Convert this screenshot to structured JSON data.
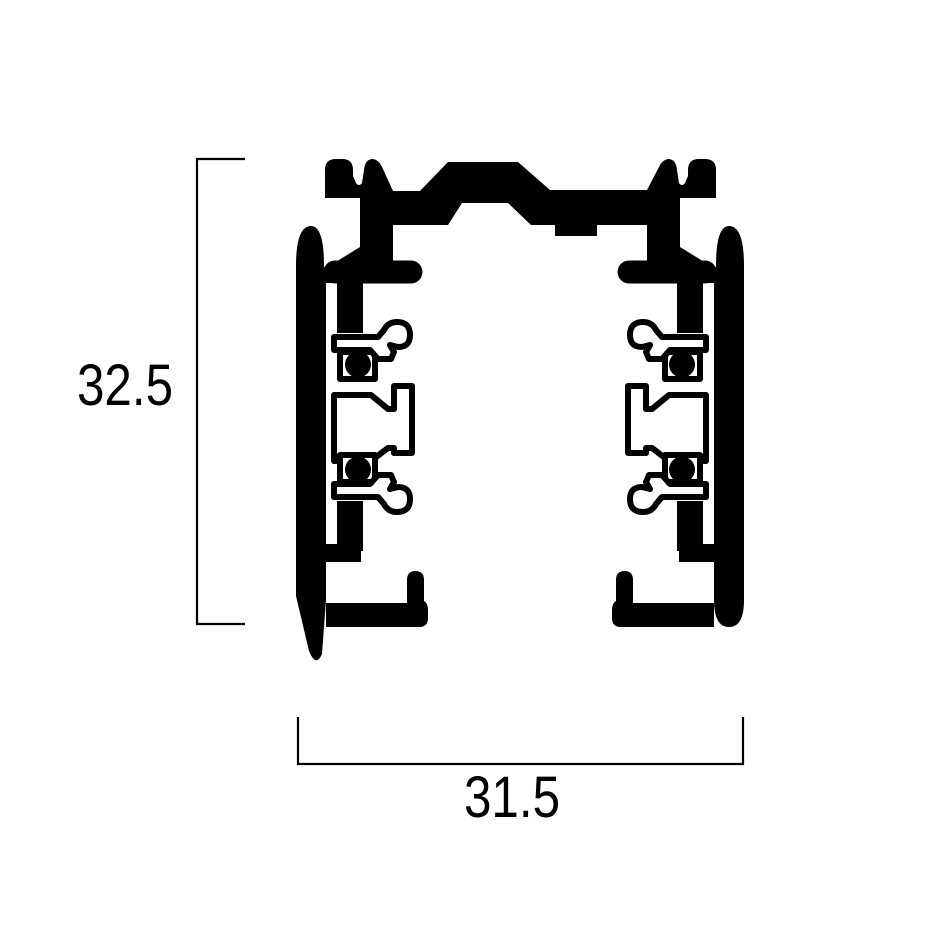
{
  "page": {
    "background_color": "#ffffff",
    "ink_color": "#000000"
  },
  "drawing": {
    "label": "lighting-track-profile-cross-section",
    "view": "section"
  },
  "dimensions": {
    "height_label": "32.5",
    "width_label": "31.5"
  }
}
